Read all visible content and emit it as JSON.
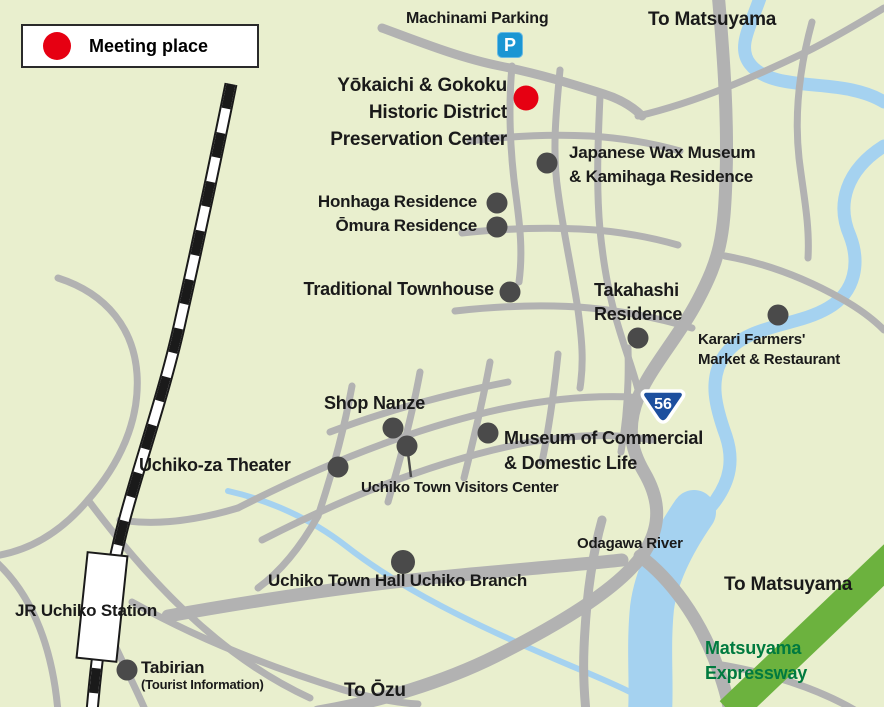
{
  "legend": {
    "label": "Meeting place"
  },
  "colors": {
    "background": "#e9efce",
    "road": "#b2b2b2",
    "river": "#a5d2f0",
    "railway": "#1a1a1a",
    "marker": "#4a4a4a",
    "meeting": "#e60012",
    "route_badge_blue": "#1d4f9e",
    "parking_blue": "#1b96d3",
    "expressway_band": "#6cb23e",
    "expressway_text_green": "#007a3f",
    "label": "#1a1a1a"
  },
  "map": {
    "parking": {
      "icon_letter": "P",
      "label": "Machinami Parking"
    },
    "directions": {
      "to_matsuyama_top": "To Matsuyama",
      "to_matsuyama_bottom": "To Matsuyama",
      "to_ozu": "To Ōzu"
    },
    "route_badge": {
      "number": "56"
    },
    "river": {
      "label": "Odagawa River"
    },
    "expressway": {
      "line1": "Matsuyama",
      "line2": "Expressway"
    },
    "railway": {
      "station_label": "JR Uchiko Station"
    },
    "places": {
      "preservation_center": {
        "line1": "Yōkaichi & Gokoku",
        "line2": "Historic District",
        "line3": "Preservation Center"
      },
      "wax_museum": {
        "line1": "Japanese Wax Museum",
        "line2": "& Kamihaga Residence"
      },
      "honhaga": {
        "label": "Honhaga Residence"
      },
      "omura": {
        "label": "Ōmura Residence"
      },
      "townhouse": {
        "label": "Traditional Townhouse"
      },
      "takahashi": {
        "line1": "Takahashi",
        "line2": "Residence"
      },
      "karari": {
        "line1": "Karari Farmers'",
        "line2": "Market & Restaurant"
      },
      "shop_nanze": {
        "label": "Shop Nanze"
      },
      "museum_commercial": {
        "line1": "Museum of Commercial",
        "line2": "& Domestic Life"
      },
      "uchikoza": {
        "label": "Uchiko-za Theater"
      },
      "visitors_center": {
        "label": "Uchiko Town Visitors Center"
      },
      "town_hall": {
        "label": "Uchiko Town Hall Uchiko Branch"
      },
      "tabirian": {
        "label": "Tabirian",
        "sublabel": "(Tourist Information)"
      }
    }
  }
}
